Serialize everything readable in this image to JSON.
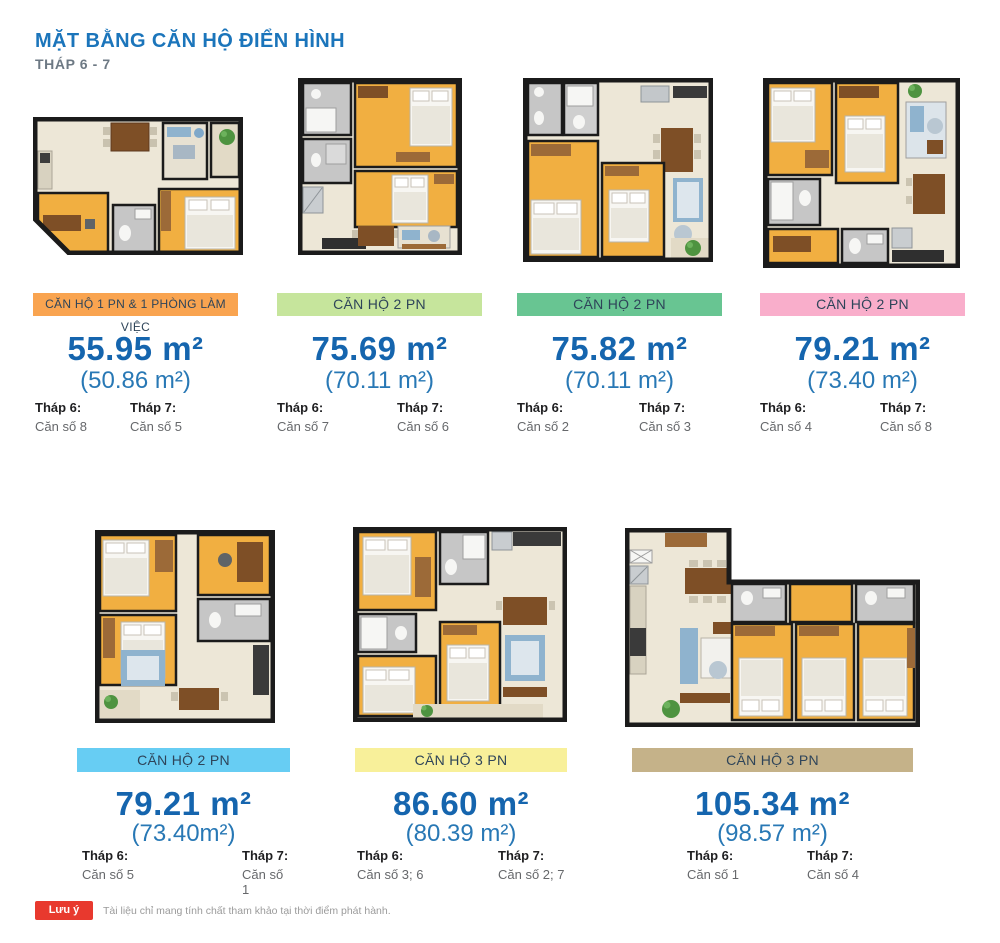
{
  "page": {
    "title": "MẶT BẰNG CĂN HỘ ĐIỂN HÌNH",
    "subtitle": "THÁP 6 - 7",
    "note_badge": "Lưu ý",
    "note_text": "Tài liệu chỉ mang tính chất tham khảo tại thời điểm phát hành."
  },
  "colors": {
    "title_blue": "#1B75BB",
    "area_blue": "#1565AE",
    "area_sub_blue": "#2878B5",
    "note_red": "#E8392E"
  },
  "apartments": [
    {
      "label": "CĂN HỘ 1 PN & 1 PHÒNG LÀM VIỆC",
      "label_color": "#F9A450",
      "area_main": "55.95 m²",
      "area_sub": "(50.86 m²)",
      "tower6_label": "Tháp 6:",
      "tower6_value": "Căn số 8",
      "tower7_label": "Tháp 7:",
      "tower7_value": "Căn số 5"
    },
    {
      "label": "CĂN HỘ 2 PN",
      "label_color": "#C6E59C",
      "area_main": "75.69 m²",
      "area_sub": "(70.11 m²)",
      "tower6_label": "Tháp 6:",
      "tower6_value": "Căn số 7",
      "tower7_label": "Tháp 7:",
      "tower7_value": "Căn số 6"
    },
    {
      "label": "CĂN HỘ 2 PN",
      "label_color": "#68C592",
      "area_main": "75.82 m²",
      "area_sub": "(70.11 m²)",
      "tower6_label": "Tháp 6:",
      "tower6_value": "Căn số 2",
      "tower7_label": "Tháp 7:",
      "tower7_value": "Căn số 3"
    },
    {
      "label": "CĂN HỘ 2 PN",
      "label_color": "#F9AECB",
      "area_main": "79.21 m²",
      "area_sub": "(73.40 m²)",
      "tower6_label": "Tháp 6:",
      "tower6_value": "Căn số 4",
      "tower7_label": "Tháp 7:",
      "tower7_value": "Căn số 8"
    },
    {
      "label": "CĂN HỘ 2 PN",
      "label_color": "#67CDF3",
      "area_main": "79.21 m²",
      "area_sub": "(73.40m²)",
      "tower6_label": "Tháp 6:",
      "tower6_value": "Căn số 5",
      "tower7_label": "Tháp 7:",
      "tower7_value": "Căn số 1"
    },
    {
      "label": "CĂN HỘ 3 PN",
      "label_color": "#F8F09A",
      "area_main": "86.60 m²",
      "area_sub": "(80.39 m²)",
      "tower6_label": "Tháp 6:",
      "tower6_value": "Căn số 3; 6",
      "tower7_label": "Tháp 7:",
      "tower7_value": "Căn số 2; 7"
    },
    {
      "label": "CĂN HỘ 3 PN",
      "label_color": "#C5B289",
      "area_main": "105.34 m²",
      "area_sub": "(98.57 m²)",
      "tower6_label": "Tháp 6:",
      "tower6_value": "Căn số 1",
      "tower7_label": "Tháp 7:",
      "tower7_value": "Căn số 4"
    }
  ]
}
